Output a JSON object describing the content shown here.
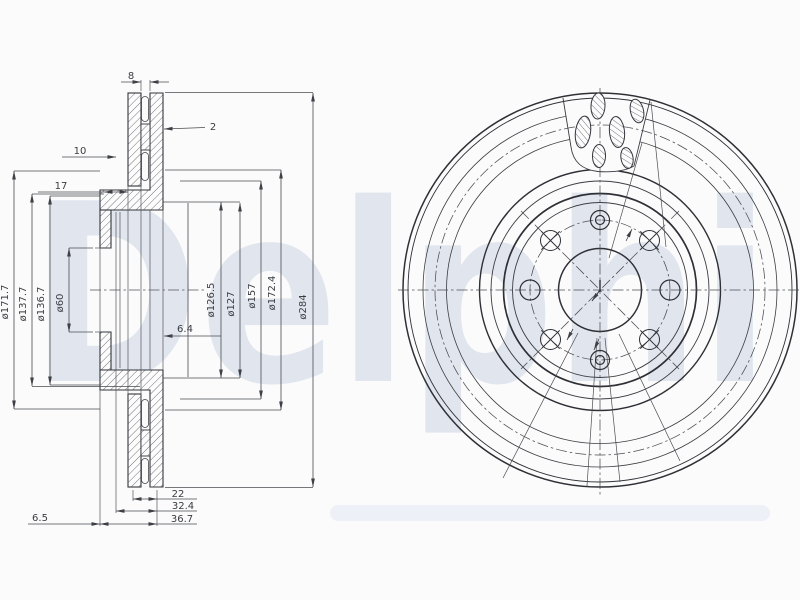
{
  "meta": {
    "type": "technical-drawing",
    "subject": "vented brake disc, cross-section and front view",
    "views": [
      "section-view",
      "front-view"
    ]
  },
  "colors": {
    "paper": "#fbfbfb",
    "part_line": "#35363c",
    "dim_line": "#4a4b51",
    "watermark": "#dee3ed"
  },
  "watermark": {
    "text": "Delphi"
  },
  "section": {
    "diameters_left": [
      "ø171.7",
      "ø137.7",
      "ø136.7",
      "ø60"
    ],
    "diameters_right": [
      "ø126.5",
      "ø127",
      "ø157",
      "ø172.4",
      "ø284"
    ],
    "top": {
      "vent_slot": "8",
      "plate": "2",
      "offset": "10",
      "depth": "17"
    },
    "middle": {
      "recess": "6.4"
    },
    "bottom": [
      "22",
      "32.4",
      "36.7"
    ],
    "bottom_left": "6.5"
  },
  "front": {
    "bolt_hole_count": 8,
    "cross_marked_holes": 4,
    "double_ring_holes": 2,
    "plain_holes": 2,
    "vent_slot_count": 6
  }
}
